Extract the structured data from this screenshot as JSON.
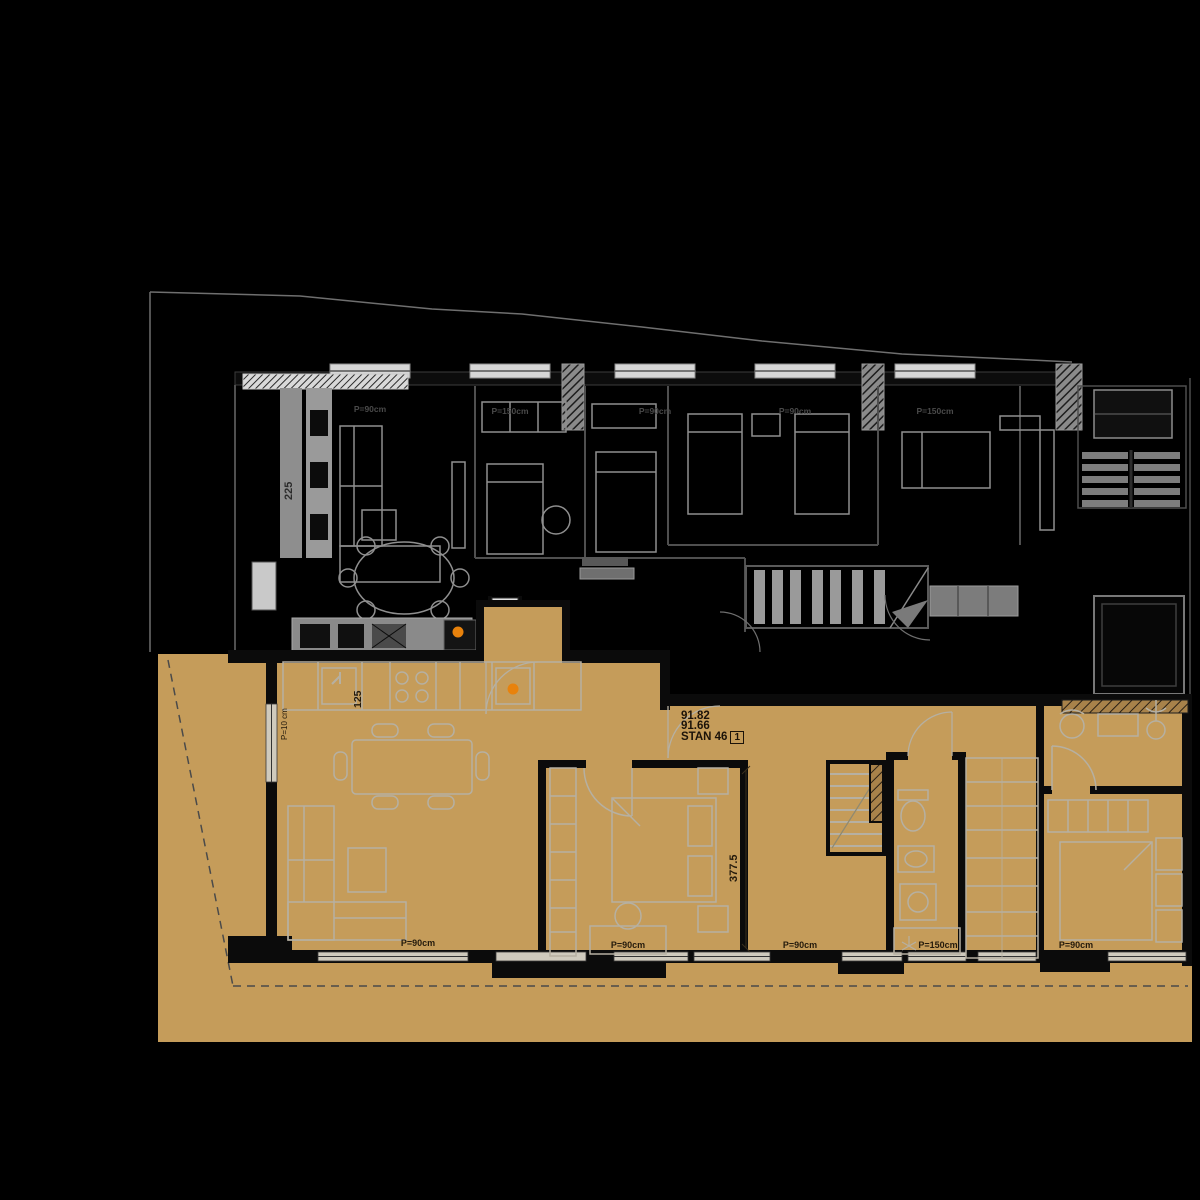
{
  "colors": {
    "background": "#000000",
    "apartment_fill": "#c59c5a",
    "accent_orange": "#e8820c",
    "furniture_gray": "#8f8f8f",
    "tan_furniture_gray": "#b6b0a2",
    "wall_black": "#0b0b0b"
  },
  "unit_label": {
    "area_line1": "91.82",
    "area_line2": "91.66",
    "unit_name": "STAN 46",
    "unit_box": "1"
  },
  "dimensions": {
    "living_height": "225",
    "kitchen_width": "125",
    "bedroom_height": "377.5",
    "parapet_low": "P=10 cm"
  },
  "windows_bottom": [
    {
      "label": "P=90cm"
    },
    {
      "label": "P=90cm"
    },
    {
      "label": "P=90cm"
    },
    {
      "label": "P=150cm"
    },
    {
      "label": "P=90cm"
    }
  ],
  "windows_top": [
    {
      "label": "P=90cm"
    },
    {
      "label": "P=150cm"
    },
    {
      "label": "P=90cm"
    },
    {
      "label": "P=90cm"
    },
    {
      "label": "P=150cm"
    }
  ]
}
